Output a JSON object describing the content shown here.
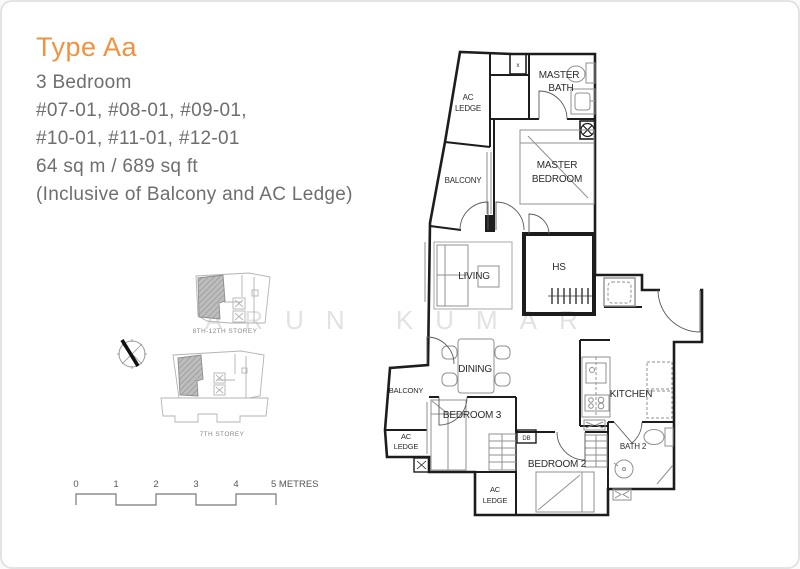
{
  "header": {
    "type_label": "Type Aa",
    "lines": [
      "3 Bedroom",
      "#07-01, #08-01, #09-01,",
      "#10-01, #11-01, #12-01",
      "64 sq m / 689 sq ft",
      "(Inclusive of Balcony and AC Ledge)"
    ]
  },
  "watermark": "ARUN KUMAR",
  "floorplan": {
    "rooms": {
      "ac_ledge_top": {
        "l1": "AC",
        "l2": "LEDGE"
      },
      "master_bath": {
        "l1": "MASTER",
        "l2": "BATH"
      },
      "master_bedroom": {
        "l1": "MASTER",
        "l2": "BEDROOM"
      },
      "balcony_upper": {
        "label": "BALCONY"
      },
      "living": {
        "label": "LIVING"
      },
      "hs": {
        "label": "HS"
      },
      "dining": {
        "label": "DINING"
      },
      "kitchen": {
        "label": "KITCHEN"
      },
      "balcony_lower": {
        "label": "BALCONY"
      },
      "ac_ledge_left": {
        "l1": "AC",
        "l2": "LEDGE"
      },
      "bedroom3": {
        "label": "BEDROOM 3"
      },
      "db": {
        "label": "DB"
      },
      "bedroom2": {
        "label": "BEDROOM 2"
      },
      "bath2": {
        "label": "BATH 2"
      },
      "ac_ledge_bottom": {
        "l1": "AC",
        "l2": "LEDGE"
      },
      "vent": {
        "label": "x"
      }
    }
  },
  "keyplans": {
    "upper_label": "8TH-12TH STOREY",
    "lower_label": "7TH STOREY"
  },
  "scalebar": {
    "ticks": [
      "0",
      "1",
      "2",
      "3",
      "4"
    ],
    "end_label": "5 METRES"
  },
  "colors": {
    "accent_orange": "#F0923F",
    "body_text": "#6E6E6E",
    "wall": "#1D1D1D",
    "fixture": "#8F8F8F",
    "keyplan_line": "#B3B3B3",
    "unit_hatch_fill": "#BDBDBD",
    "watermark": "#CFCFCF"
  }
}
